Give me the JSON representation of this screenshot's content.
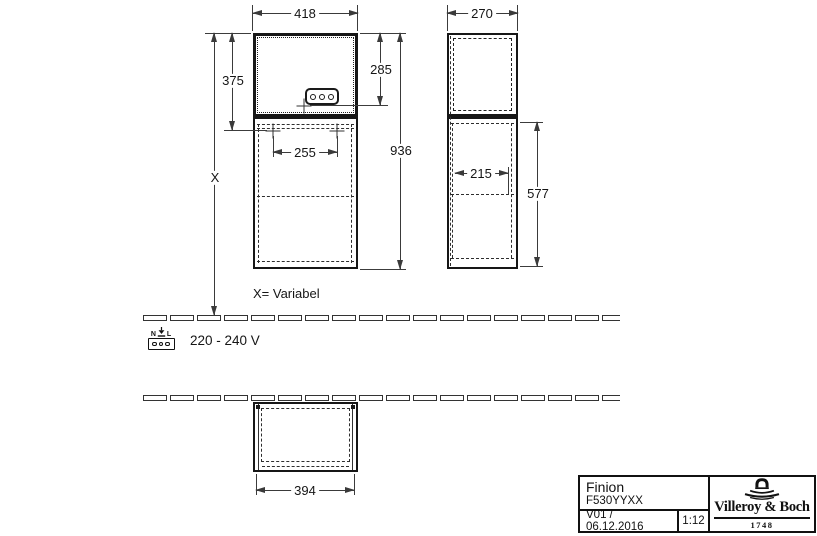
{
  "dimensions": {
    "front_width": "418",
    "upper_section_height": "375",
    "socket_height_from_top": "285",
    "total_height": "936",
    "variable_height": "X",
    "mounting_spacing": "255",
    "side_depth": "270",
    "side_inner_depth": "215",
    "lower_section_height": "577",
    "plan_width": "394"
  },
  "annotations": {
    "variable_note": "X= Variabel",
    "voltage": "220 - 240 V",
    "socket_n": "N",
    "socket_l": "L"
  },
  "title_block": {
    "product_name": "Finion",
    "product_code": "F530YYXX",
    "version_date": "V01 / 06.12.2016",
    "scale": "1:12",
    "brand_name": "Villeroy & Boch",
    "brand_year": "1748"
  }
}
